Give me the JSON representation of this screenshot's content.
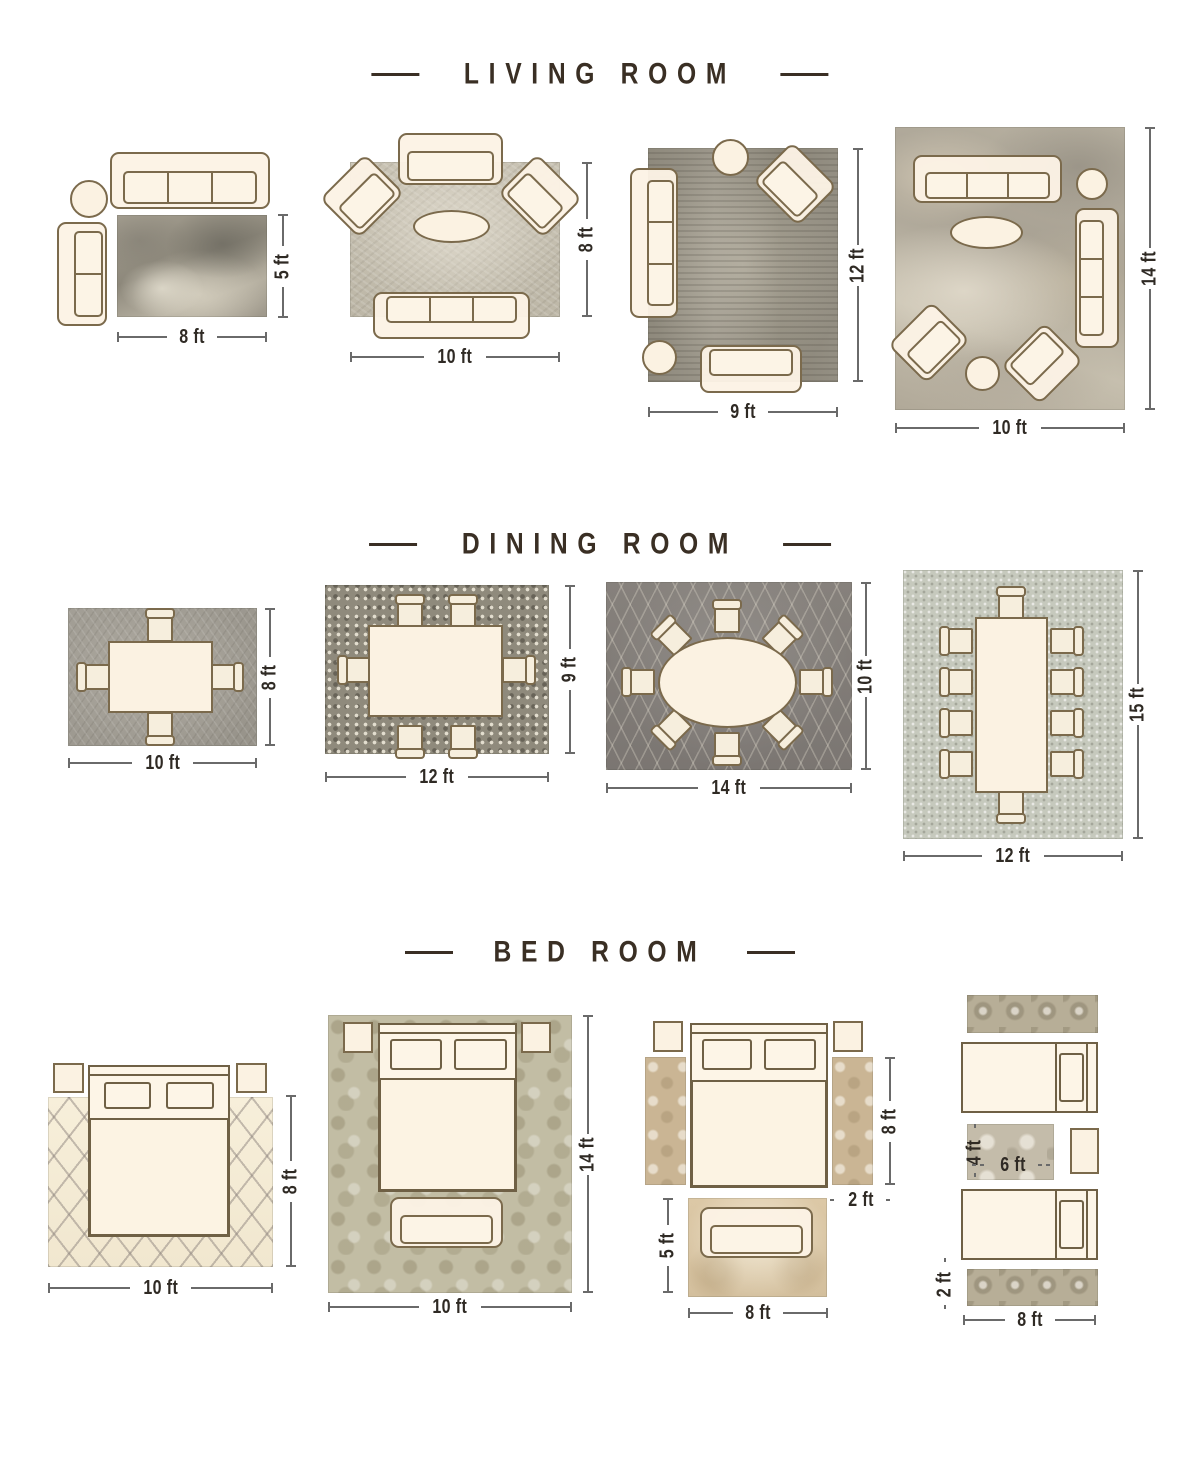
{
  "colors": {
    "background": "#ffffff",
    "title_text": "#3a2f24",
    "dimension_line": "#6a6a6a",
    "dimension_text": "#2f2a24",
    "furniture_fill": "#fbf2e2",
    "furniture_outline": "#7b6a4c"
  },
  "sections": [
    {
      "title": "LIVING ROOM",
      "layouts": [
        {
          "dims": {
            "w": "8 ft",
            "h": "5 ft"
          }
        },
        {
          "dims": {
            "w": "10 ft",
            "h": "8 ft"
          }
        },
        {
          "dims": {
            "w": "9 ft",
            "h": "12 ft"
          }
        },
        {
          "dims": {
            "w": "10 ft",
            "h": "14 ft"
          }
        }
      ]
    },
    {
      "title": "DINING ROOM",
      "layouts": [
        {
          "dims": {
            "w": "10 ft",
            "h": "8 ft"
          }
        },
        {
          "dims": {
            "w": "12 ft",
            "h": "9 ft"
          }
        },
        {
          "dims": {
            "w": "14 ft",
            "h": "10 ft"
          }
        },
        {
          "dims": {
            "w": "12 ft",
            "h": "15 ft"
          }
        }
      ]
    },
    {
      "title": "BED ROOM",
      "layouts": [
        {
          "dims": {
            "w": "10 ft",
            "h": "8 ft"
          }
        },
        {
          "dims": {
            "w": "10 ft",
            "h": "14 ft"
          }
        },
        {
          "dims": {
            "bed_side_h": "8 ft",
            "runner_w": "2 ft",
            "foot_rug_h": "5 ft",
            "foot_rug_w": "8 ft"
          }
        },
        {
          "dims": {
            "accent_rug_h": "4 ft",
            "accent_rug_w": "6 ft",
            "runner_h": "2 ft",
            "runner_w": "8 ft"
          }
        }
      ]
    }
  ]
}
